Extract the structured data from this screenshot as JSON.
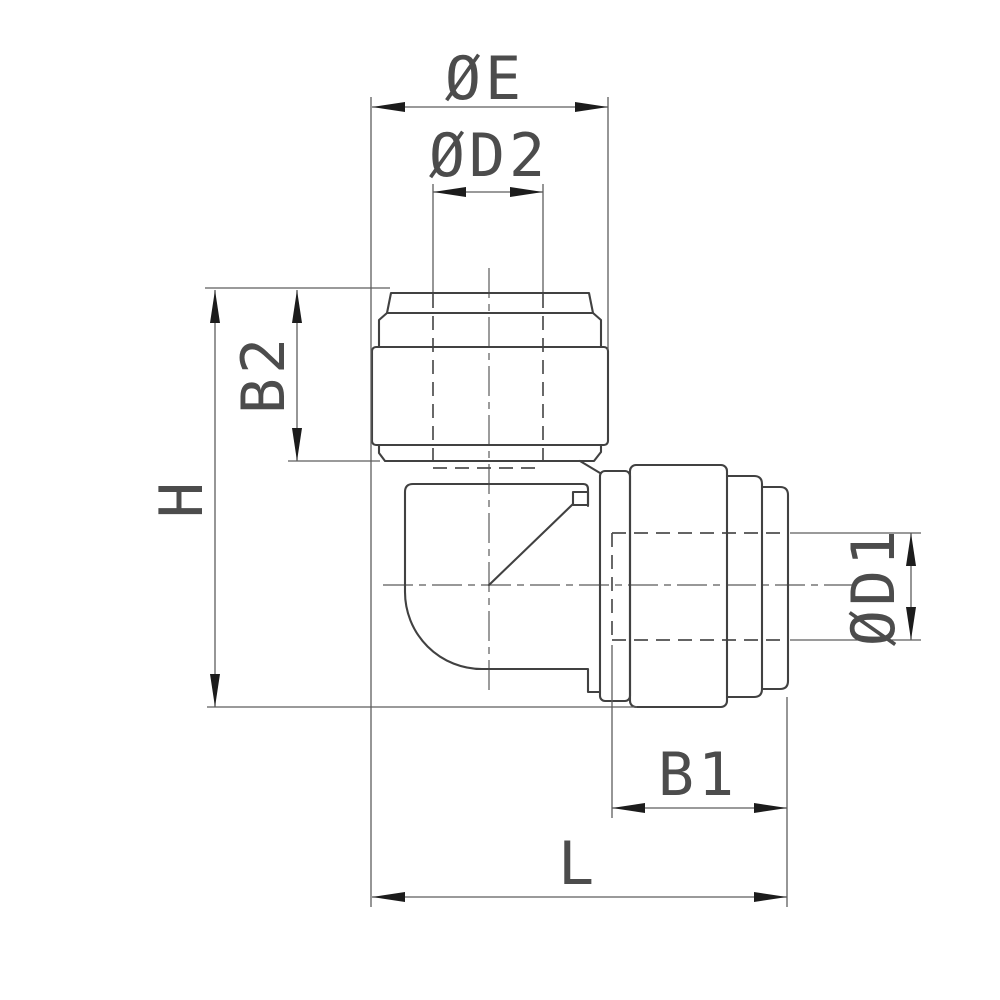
{
  "drawing": {
    "title": "Push-fit elbow fitting - dimensioned engineering drawing",
    "view": "90-degree elbow side view with vertical and horizontal push-in collets",
    "background": "#ffffff",
    "colors": {
      "outline": "#414141",
      "dimension_lines": "#5d5d5d",
      "hidden_lines": "#4f4f4f",
      "centerlines": "#5a5a5a",
      "arrows": "#1c1c1c",
      "text": "#4c4c4c"
    }
  },
  "dimensions": [
    {
      "id": "oe",
      "label": "ØE",
      "orientation": "horizontal",
      "location": "top outer width of vertical collet ring"
    },
    {
      "id": "od2",
      "label": "ØD2",
      "orientation": "horizontal",
      "location": "top bore diameter of vertical leg"
    },
    {
      "id": "b2",
      "label": "B2",
      "orientation": "vertical",
      "location": "left, vertical collet depth"
    },
    {
      "id": "h",
      "label": "H",
      "orientation": "vertical",
      "location": "left, overall height"
    },
    {
      "id": "od1",
      "label": "ØD1",
      "orientation": "vertical",
      "location": "right, bore diameter of horizontal leg"
    },
    {
      "id": "b1",
      "label": "B1",
      "orientation": "horizontal",
      "location": "bottom right, horizontal collet depth"
    },
    {
      "id": "l",
      "label": "L",
      "orientation": "horizontal",
      "location": "bottom, overall length"
    }
  ]
}
